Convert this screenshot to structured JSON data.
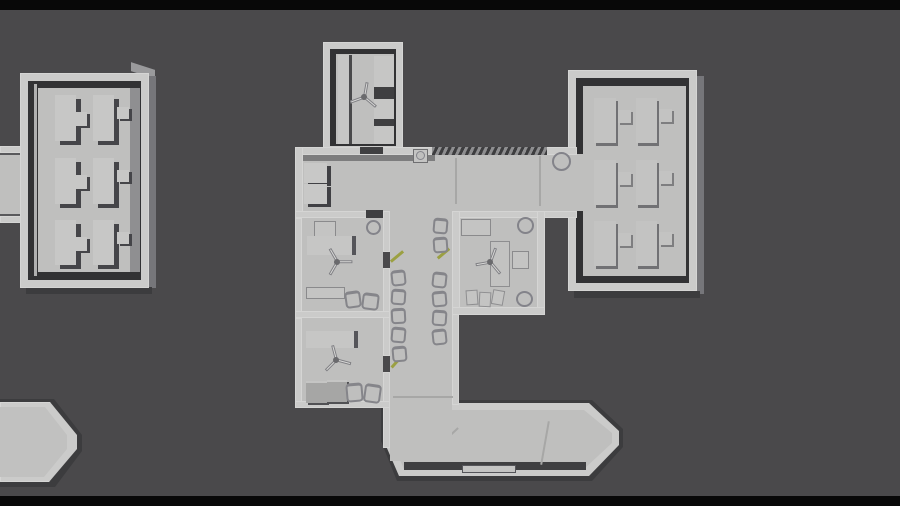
{
  "view": {
    "label": "top-down orthographic greybox render of a modular base level"
  },
  "palette": {
    "letterbox": "#080808",
    "bg": "#4a494b",
    "wall": "#cbcbca",
    "floor": "#bfbfbe",
    "floor2": "#b8b8b7",
    "inset": "#323234",
    "inset2": "#3f3f41",
    "side": "#76767a",
    "sidedark": "#3c3c3e",
    "furn": "#c8c8c7",
    "green": "#9ba042"
  },
  "scene": {
    "buildings": [
      {
        "id": "west-dormitory",
        "label": "west dormitory wing",
        "bunk_rows": 3
      },
      {
        "id": "west-corridor-stub",
        "label": "corridor stub to west edge"
      },
      {
        "id": "landing-pad",
        "label": "south-west beveled pad"
      },
      {
        "id": "north-fan-room",
        "label": "north room with ceiling fan and shelves",
        "shelves": 3
      },
      {
        "id": "central-hall",
        "label": "central hall",
        "fixtures": [
          "storage-cabinet",
          "wash-basin",
          "hatched-locker-strip",
          "round-table"
        ]
      },
      {
        "id": "office-upper",
        "label": "upper office with fan, desk, bench, two chairs"
      },
      {
        "id": "office-lower",
        "label": "lower office with fan, desk, two crates, two chairs"
      },
      {
        "id": "lounge-office",
        "label": "east office with fan, desk, couch, corner tables"
      },
      {
        "id": "waiting-corridor",
        "label": "waiting corridor",
        "chairs_left": 5,
        "chairs_right": 6,
        "door_markers": 3
      },
      {
        "id": "east-dormitory",
        "label": "east dormitory wing",
        "bunk_rows": 3,
        "bunk_columns": 2
      },
      {
        "id": "south-walkway",
        "label": "south walkway with beveled end and entrance mark"
      }
    ],
    "totals": {
      "ceiling_fans": 4,
      "waiting_chairs": 11,
      "bunks": 9,
      "door_markers": 3
    }
  }
}
